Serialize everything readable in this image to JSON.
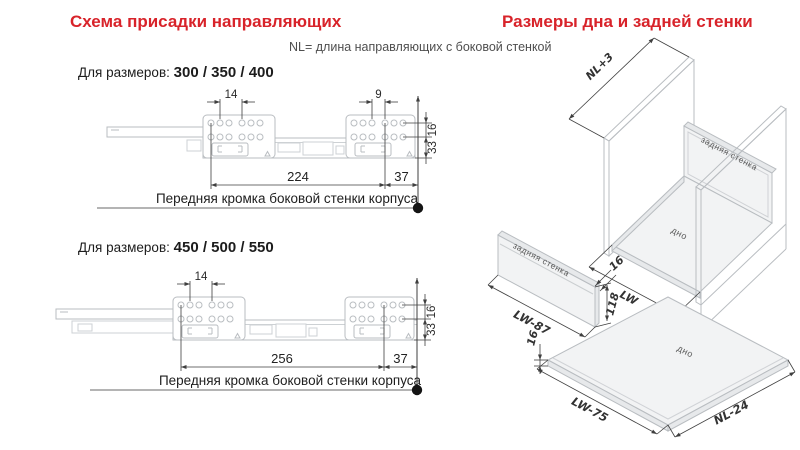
{
  "colors": {
    "accent": "#d8232a",
    "drawing_line": "#b9bdc1",
    "dimension_line": "#3f3f3f"
  },
  "header": {
    "left_title": "Схема присадки направляющих",
    "right_title": "Размеры дна и задней стенки",
    "note": "NL= длина направляющих с боковой стенкой"
  },
  "drawings": {
    "d1": {
      "for_sizes_prefix": "Для размеров:",
      "for_sizes": "300 / 350 / 400",
      "dim_hole_pitch_left": "14",
      "dim_hole_pitch_right": "9",
      "dim_row_gap": "16",
      "dim_bottom_offset": "33",
      "dim_front_to_hole": "224",
      "dim_edge_offset": "37",
      "front_edge_label": "Передняя кромка боковой стенки корпуса"
    },
    "d2": {
      "for_sizes_prefix": "Для размеров:",
      "for_sizes": "450 / 500 / 550",
      "dim_hole_pitch_left": "14",
      "dim_row_gap": "16",
      "dim_bottom_offset": "33",
      "dim_front_to_hole": "256",
      "dim_edge_offset": "37",
      "front_edge_label": "Передняя кромка боковой стенки корпуса"
    }
  },
  "panels": {
    "assembly": {
      "depth_dim": "NL+3",
      "width_dim": "LW",
      "back_wall_label": "задняя стенка",
      "bottom_label": "дно"
    },
    "back_wall": {
      "label": "задняя стенка",
      "width_dim": "LW-87",
      "height_dim": "118",
      "thickness_dim": "16"
    },
    "bottom": {
      "label": "дно",
      "width_dim": "LW-75",
      "length_dim": "NL-24",
      "thickness_dim": "16"
    }
  }
}
